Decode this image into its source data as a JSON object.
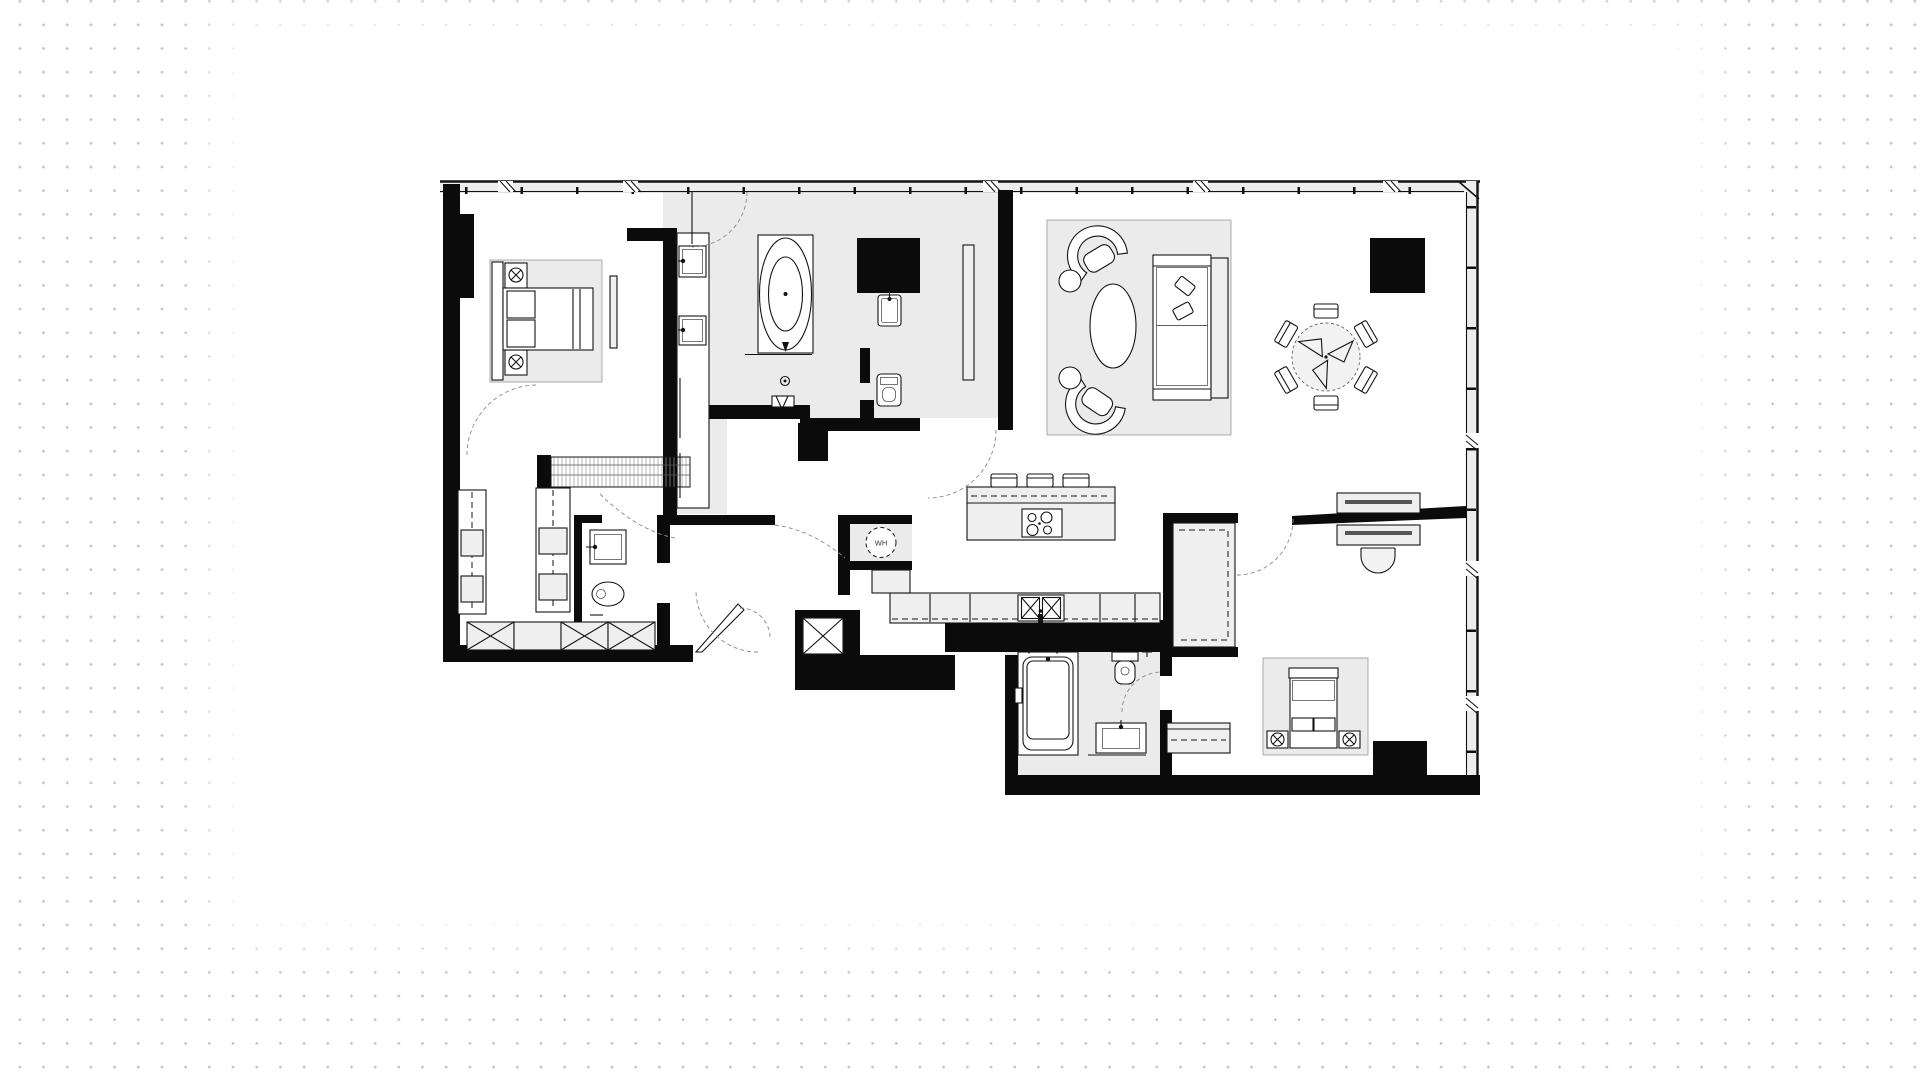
{
  "plan": {
    "type": "apartment-floor-plan",
    "water_heater_label": "WH"
  },
  "colors": {
    "wall": "#0b0b0b",
    "floor": "#ebebeb",
    "paper": "#ffffff",
    "background_dot": "#c6c6c6",
    "line": "#141414"
  },
  "symbols": [
    "double-bed",
    "nightstand-lamp",
    "area-rug",
    "freestanding-oval-bathtub",
    "walk-in-shower",
    "vanity-sink",
    "toilet",
    "floor-drain",
    "mirror-panel",
    "wardrobe-unit",
    "storage-x-cabinet",
    "powder-room-sink",
    "kitchen-island-cooktop",
    "bar-stool",
    "double-kitchen-sink",
    "water-heater",
    "sofa",
    "tub-armchair",
    "coffee-table",
    "side-table",
    "round-dining-table",
    "dining-chair",
    "structural-column",
    "desk",
    "desk-chair",
    "built-in-bathtub",
    "window-mullion",
    "door-swing",
    "entry-door-leaf"
  ]
}
